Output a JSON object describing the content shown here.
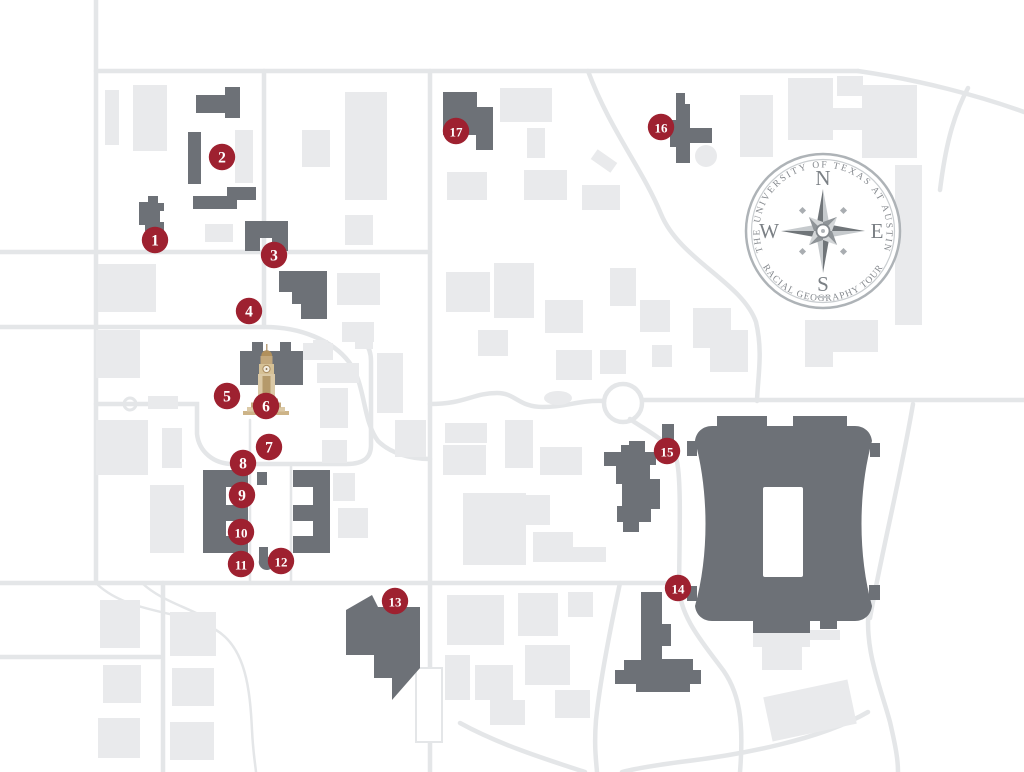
{
  "icons": {
    "compass_rose": "compass-rose-icon",
    "tower": "ut-tower-icon"
  },
  "colors": {
    "background": "#ffffff",
    "street": "#e4e6e8",
    "light_building": "#e9eaec",
    "dark_building": "#6d7177",
    "field": "#ffffff",
    "marker": "#9e2130",
    "marker_text": "#ffffff",
    "compass_ring": "#aeb3b7",
    "compass_inner_ring": "#c9cdd0",
    "star_dark": "#707579",
    "star_light": "#c6cacd",
    "star_short_dark": "#8f9498",
    "star_short_light": "#d3d6d8",
    "tower_light": "#dbc9a6",
    "tower_mid": "#c3a87c",
    "tower_dark": "#a98a5d",
    "tower_accent": "#9a5f41"
  },
  "compass": {
    "top_text": "THE UNIVERSITY OF TEXAS AT AUSTIN",
    "bottom_text": "RACIAL GEOGRAPHY TOUR",
    "north": "N",
    "east": "E",
    "south": "S",
    "west": "W"
  },
  "markers": [
    {
      "n": "1",
      "x": 155,
      "y": 240
    },
    {
      "n": "2",
      "x": 222,
      "y": 157
    },
    {
      "n": "3",
      "x": 274,
      "y": 255
    },
    {
      "n": "4",
      "x": 249,
      "y": 311
    },
    {
      "n": "5",
      "x": 227,
      "y": 396
    },
    {
      "n": "6",
      "x": 266,
      "y": 406
    },
    {
      "n": "7",
      "x": 269,
      "y": 447
    },
    {
      "n": "8",
      "x": 243,
      "y": 463
    },
    {
      "n": "9",
      "x": 242,
      "y": 495
    },
    {
      "n": "10",
      "x": 241,
      "y": 532
    },
    {
      "n": "11",
      "x": 241,
      "y": 564
    },
    {
      "n": "12",
      "x": 281,
      "y": 561
    },
    {
      "n": "13",
      "x": 395,
      "y": 601
    },
    {
      "n": "14",
      "x": 678,
      "y": 588
    },
    {
      "n": "15",
      "x": 667,
      "y": 451
    },
    {
      "n": "16",
      "x": 661,
      "y": 127
    },
    {
      "n": "17",
      "x": 456,
      "y": 131
    }
  ],
  "geometry": {
    "streets": [
      {
        "d": "M96,0 V583"
      },
      {
        "d": "M96,71 H858"
      },
      {
        "d": "M858,71 C920,80 980,96 1024,112"
      },
      {
        "d": "M264,71 V327"
      },
      {
        "d": "M0,252 H430"
      },
      {
        "d": "M0,327 H265 C300,327 332,340 349,362 C366,384 362,420 378,441 C390,453 410,459 430,459"
      },
      {
        "d": "M430,71 V772"
      },
      {
        "d": "M0,583 H678"
      },
      {
        "d": "M643,400 H1024"
      },
      {
        "d": "M430,404 C465,404 473,393 497,393 C516,393 518,407 543,407 C568,407 577,400 604,401"
      },
      {
        "d": "M588,71 C610,130 642,168 661,214 C680,260 742,282 756,322 C763,352 758,375 757,401"
      },
      {
        "d": "M630,419 C645,430 668,440 676,458 C681,472 680,520 679,585"
      },
      {
        "d": "M679,585 C679,615 702,642 720,666 C740,691 744,722 740,772"
      },
      {
        "d": "M620,583 C610,630 600,680 596,720 C594,745 596,760 597,772"
      },
      {
        "d": "M913,404 C900,480 880,560 870,618"
      },
      {
        "d": "M870,600 C862,645 880,685 890,722 C896,748 898,760 898,772"
      },
      {
        "d": "M868,712 C820,740 740,755 680,762 C650,766 630,770 622,772"
      },
      {
        "d": "M460,723 C500,745 548,760 585,772"
      },
      {
        "d": "M0,657 H160"
      },
      {
        "d": "M163,583 V772"
      },
      {
        "d": "M940,190 C945,150 952,118 968,88"
      },
      {
        "d": "M347,331 C363,336 371,346 371,361 V445 C371,459 362,464 347,464 H233 C214,464 199,452 197,434 V404 H96"
      },
      {
        "d": "M98,585 C130,614 182,610 216,630 C246,648 250,690 252,730 C253,752 255,762 256,772",
        "w": 2.5
      },
      {
        "d": "M142,583 C160,600 184,606 206,618",
        "w": 2.5
      },
      {
        "d": "M250,420 V583",
        "w": 2.5
      },
      {
        "d": "M291,464 V583",
        "w": 2.5
      }
    ],
    "roundabout": {
      "cx": 623,
      "cy": 403,
      "r": 19
    },
    "fountain": {
      "cx": 130,
      "cy": 404,
      "r": 6
    },
    "pond": {
      "cx": 558,
      "cy": 398,
      "rx": 14,
      "ry": 7
    },
    "light_rects": [
      [
        105,
        90,
        14,
        55
      ],
      [
        133,
        85,
        34,
        66
      ],
      [
        235,
        130,
        18,
        53
      ],
      [
        302,
        130,
        28,
        37
      ],
      [
        345,
        92,
        42,
        108
      ],
      [
        205,
        224,
        28,
        18
      ],
      [
        345,
        215,
        28,
        30
      ],
      [
        98,
        264,
        58,
        48
      ],
      [
        96,
        330,
        44,
        48
      ],
      [
        148,
        396,
        30,
        13
      ],
      [
        96,
        420,
        52,
        55
      ],
      [
        162,
        428,
        20,
        40
      ],
      [
        150,
        485,
        34,
        68
      ],
      [
        303,
        343,
        30,
        17
      ],
      [
        317,
        363,
        42,
        20
      ],
      [
        320,
        388,
        28,
        40
      ],
      [
        322,
        440,
        25,
        23
      ],
      [
        355,
        332,
        18,
        17
      ],
      [
        377,
        353,
        26,
        60
      ],
      [
        395,
        420,
        31,
        37
      ],
      [
        337,
        273,
        43,
        32
      ],
      [
        342,
        322,
        32,
        20
      ],
      [
        313,
        340,
        15,
        15
      ],
      [
        333,
        473,
        22,
        28
      ],
      [
        338,
        508,
        30,
        30
      ],
      [
        100,
        600,
        40,
        48
      ],
      [
        170,
        612,
        46,
        44
      ],
      [
        103,
        665,
        38,
        38
      ],
      [
        172,
        668,
        42,
        38
      ],
      [
        98,
        718,
        42,
        40
      ],
      [
        170,
        722,
        44,
        38
      ],
      [
        500,
        88,
        52,
        34
      ],
      [
        527,
        128,
        18,
        30
      ],
      [
        447,
        172,
        40,
        28
      ],
      [
        524,
        170,
        43,
        30
      ],
      [
        582,
        185,
        38,
        25
      ],
      [
        446,
        272,
        44,
        40
      ],
      [
        494,
        263,
        40,
        55
      ],
      [
        545,
        300,
        38,
        33
      ],
      [
        556,
        350,
        36,
        30
      ],
      [
        478,
        330,
        30,
        26
      ],
      [
        610,
        268,
        26,
        38
      ],
      [
        640,
        300,
        30,
        32
      ],
      [
        600,
        350,
        26,
        24
      ],
      [
        652,
        345,
        20,
        22
      ],
      [
        445,
        423,
        42,
        20
      ],
      [
        505,
        420,
        28,
        48
      ],
      [
        540,
        447,
        42,
        28
      ],
      [
        443,
        445,
        43,
        30
      ],
      [
        463,
        493,
        63,
        72
      ],
      [
        525,
        495,
        25,
        30
      ],
      [
        533,
        532,
        40,
        30
      ],
      [
        573,
        547,
        33,
        15
      ],
      [
        447,
        595,
        57,
        50
      ],
      [
        518,
        593,
        40,
        43
      ],
      [
        568,
        592,
        25,
        25
      ],
      [
        445,
        655,
        25,
        45
      ],
      [
        475,
        665,
        38,
        35
      ],
      [
        525,
        645,
        45,
        40
      ],
      [
        490,
        700,
        35,
        25
      ],
      [
        555,
        690,
        35,
        28
      ],
      [
        740,
        95,
        33,
        62
      ],
      [
        788,
        78,
        45,
        62
      ],
      [
        833,
        108,
        30,
        22
      ],
      [
        837,
        76,
        26,
        20
      ],
      [
        862,
        85,
        55,
        73
      ],
      [
        895,
        165,
        27,
        160
      ],
      [
        693,
        308,
        38,
        40
      ],
      [
        710,
        330,
        38,
        42
      ],
      [
        805,
        320,
        73,
        32
      ],
      [
        805,
        352,
        28,
        15
      ],
      [
        753,
        627,
        57,
        20
      ],
      [
        762,
        647,
        40,
        23
      ],
      [
        810,
        630,
        30,
        10
      ]
    ],
    "rotated_rects": [
      {
        "x": 592,
        "y": 155,
        "w": 24,
        "h": 12,
        "r": 35
      },
      {
        "x": 767,
        "y": 688,
        "w": 86,
        "h": 45,
        "r": -12
      }
    ],
    "outline_rects": [
      [
        416,
        668,
        26,
        74
      ]
    ],
    "light_circles": [
      {
        "cx": 706,
        "cy": 156,
        "r": 11
      }
    ],
    "dark_paths": [
      "M139,202 h9 v-6 h10 v7 h6 v8 h-4 v11 h4 v9 h-19 v-6 h-6 z",
      "M196,95 h29 v-8 h15 v31 h-15 v-5 h-29 z",
      "M188,132 h13 v52 h-13 z",
      "M193,196 h34 v-9 h29 v13 h-19 v9 h-44 z",
      "M245,221 h43 v30 h-16 v-13 h-12 v13 h-15 z",
      "M279,271 h48 v48 h-26 v-15 h-9 v-12 h-13 z",
      "M240,351 h12 v-9 h11 v9 h17 v-9 h11 v9 h12 v34 h-63 z",
      "M203,470 h45 v17 h-22 v18 h22 v16 h-22 v15 h22 v17 h-45 z",
      "M293,470 h37 v83 h-37 v-17 h20 v-15 h-20 v-16 h20 v-18 h-20 z",
      "M257,472 h10 v13 h-10 z",
      "M259,547 h9 v10 h5 a8,8 0 1 1 -14,3 z",
      "M346,610 L372,595 L378,607 L420,607 L420,668 L392,700 L392,678 L374,678 L374,655 L346,655 Z",
      "M604,452 h17 v-7 h8 v-4 h16 v11 h11 v13 h-6 v14 h10 v30 h-9 v13 h-12 v10 h-16 v-10 h-6 v-16 h5 v-22 h-6 v-18 h-12 z",
      "M662,424 h12 v17 h-12 z",
      "M641,592 h21 v32 h9 v22 h-9 v13 h31 v11 h8 v14 h-11 v8 h-54 v-8 h-21 v-14 h9 v-10 h17 z",
      "M676,93 h9 v11 h5 v24 h22 v15 h-22 v20 h-14 v-16 h-6 v-27 h6 z",
      "M443,92 h34 v15 h16 v43 h-17 v-15 h-33 z"
    ],
    "stadium_path": "M712,426 H855 C864,426 871,432 872,441 C858,492 858,556 872,606 C871,615 864,621 855,621 H712 C703,621 696,615 695,606 C709,556 709,492 695,441 C696,432 703,426 712,426 Z M717,416 h50 v12 h-50 z M793,416 h54 v12 h-54 z M687,441 h10 v15 h-10 z M687,586 h10 v15 h-10 z M870,443 h10 v14 h-10 z M869,585 h11 v15 h-11 z M753,619 h57 v14 h-57 z M820,617 h17 v12 h-17 z",
    "stadium_field": [
      763,
      487,
      40,
      90
    ]
  }
}
